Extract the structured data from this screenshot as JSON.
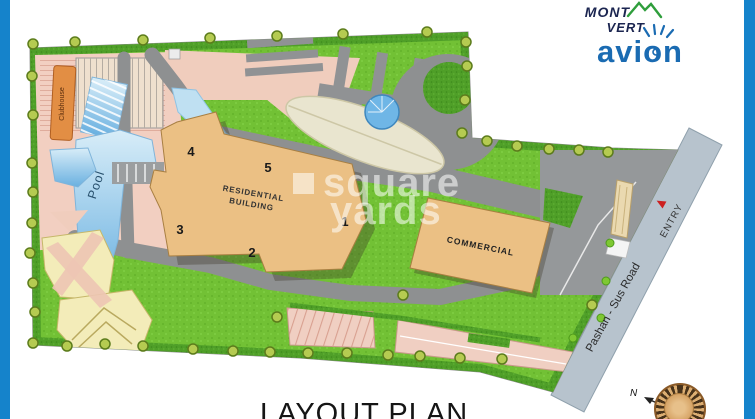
{
  "logo": {
    "mont": "MONT",
    "vert": "VERT",
    "brand": "avion"
  },
  "watermark": {
    "word1": "square",
    "word2": "yards"
  },
  "title": {
    "text": "LAYOUT PLAN"
  },
  "map": {
    "clubhouse": "Clubhouse",
    "pool": "Pool",
    "residential_line1": "RESIDENTIAL",
    "residential_line2": "BUILDING",
    "commercial": "COMMERCIAL",
    "entry": "ENTRY",
    "road": "Pashan - Sus Road",
    "north": "N",
    "numbers": [
      "1",
      "2",
      "3",
      "4",
      "5"
    ]
  },
  "colors": {
    "accent_blue": "#1583cb",
    "lawn_green": "#72c135",
    "hedge_green": "#4f9f28",
    "road_gray": "#8e9091",
    "main_road_gray": "#b7c3cd",
    "building_tan": "#ebc084",
    "pool_blue": "#69b0e0",
    "deck_pink": "#f2cfc1",
    "clubhouse_orange": "#e28e44",
    "entry_arrow_red": "#cc2020",
    "brand_blue": "#1a6bb2",
    "brand_navy": "#1b2550",
    "brand_green": "#2f9e3c"
  }
}
